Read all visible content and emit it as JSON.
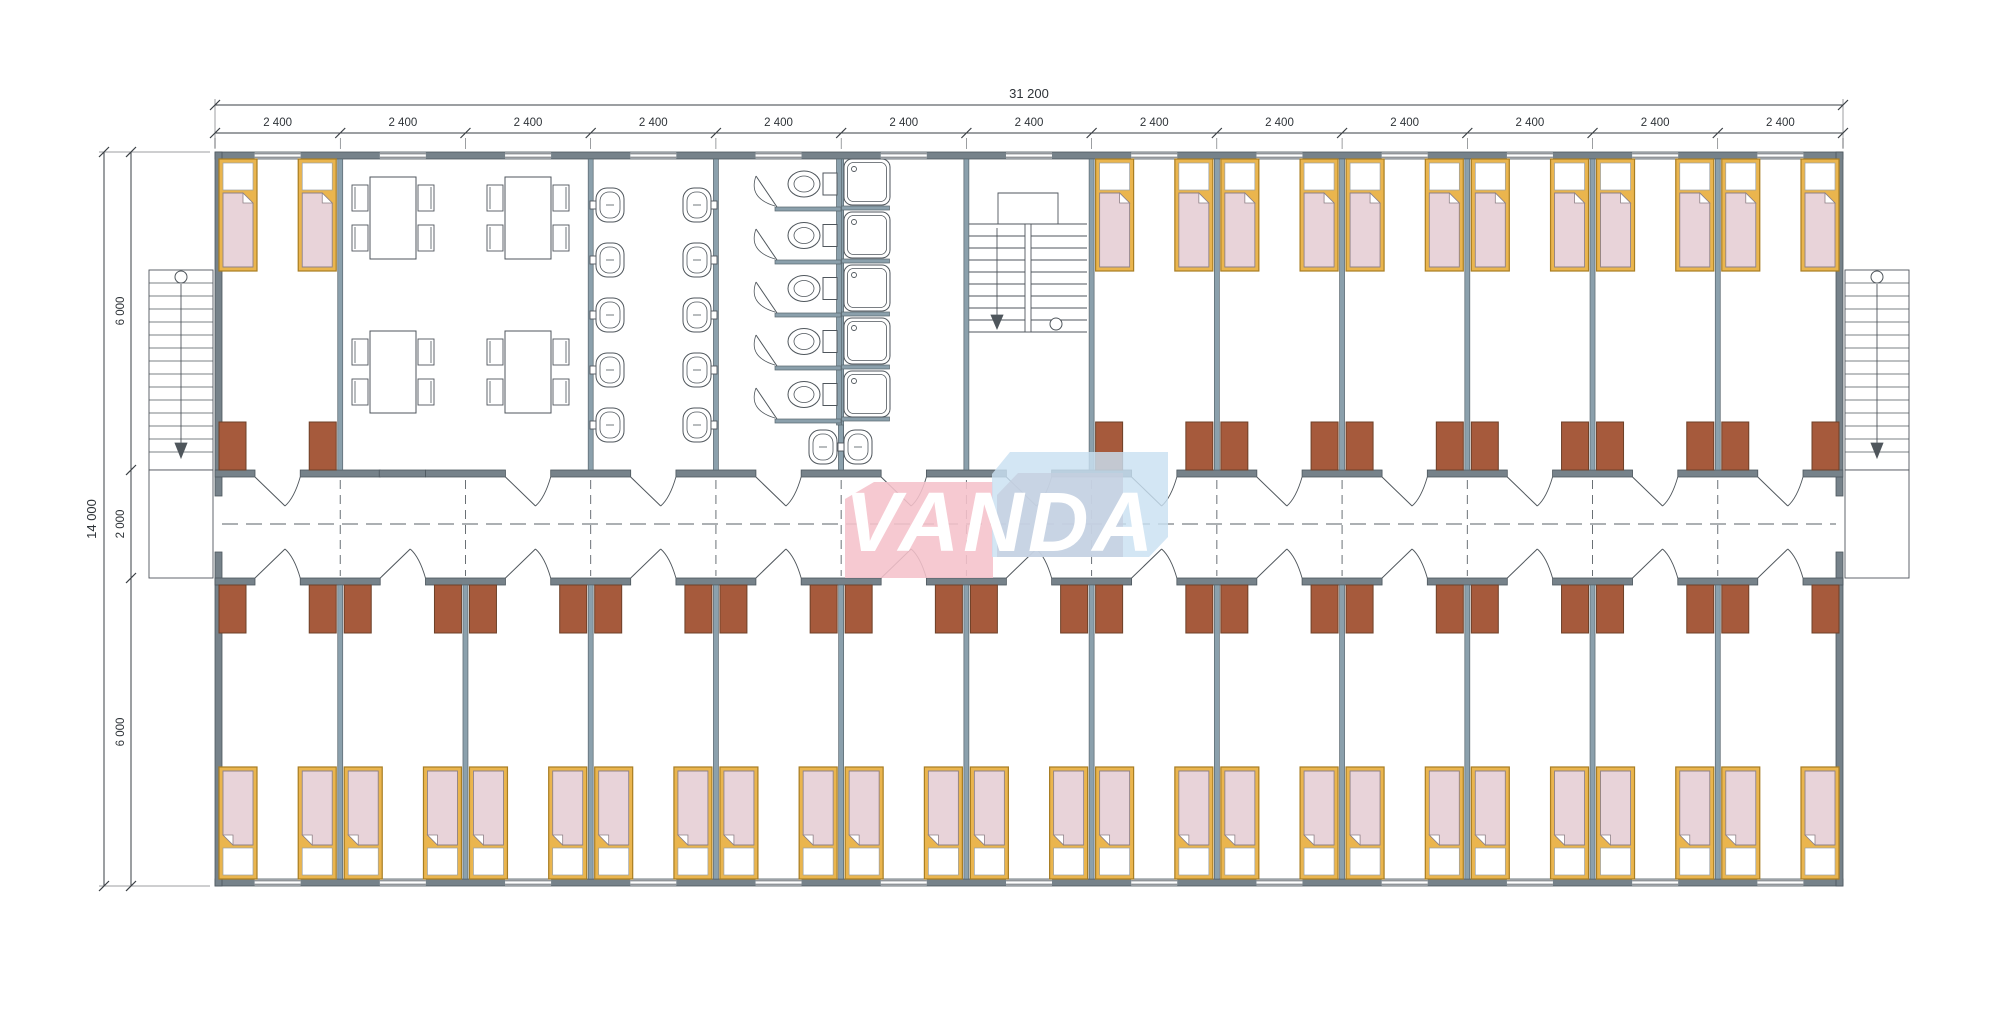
{
  "logo": {
    "text": "VANDA",
    "pink": "#f5c2cb",
    "blue": "#c9e0f2",
    "blue_inner": "#c5cedf",
    "text_color": "#ffffff"
  },
  "dimensions": {
    "top_total": "31 200",
    "top_segments": [
      "2 400",
      "2 400",
      "2 400",
      "2 400",
      "2 400",
      "2 400",
      "2 400",
      "2 400",
      "2 400",
      "2 400",
      "2 400",
      "2 400",
      "2 400"
    ],
    "left_total": "14 000",
    "left_segments": [
      "6 000",
      "2 000",
      "6 000"
    ]
  },
  "palette": {
    "wall": "#76828a",
    "wall_stroke": "#4d575e",
    "partition": "#8ba0ac",
    "partition_stroke": "#59666e",
    "bed_frame": "#eab54e",
    "bed_frame_stroke": "#a87d22",
    "bed_blanket": "#e8d3d9",
    "bed_blanket_stroke": "#8f8288",
    "nightstand": "#a65a3c",
    "nightstand_stroke": "#6d4028",
    "fixture_line": "#4f565c",
    "dim_line": "#3a3f44",
    "centerline": "#5a6167",
    "background": "#ffffff"
  },
  "fixtures": {
    "bed": "bed",
    "nightstand": "nightstand",
    "dining_table": "dining-table",
    "chair": "chair",
    "sink": "sink",
    "toilet": "toilet",
    "shower": "shower-tray",
    "staircase": "staircase",
    "door": "door-swing",
    "window": "window"
  },
  "counts": {
    "beds": 40,
    "nightstands": 40,
    "dining_tables": 4,
    "sinks": 12,
    "toilets": 5,
    "showers": 5,
    "staircases": 3
  }
}
